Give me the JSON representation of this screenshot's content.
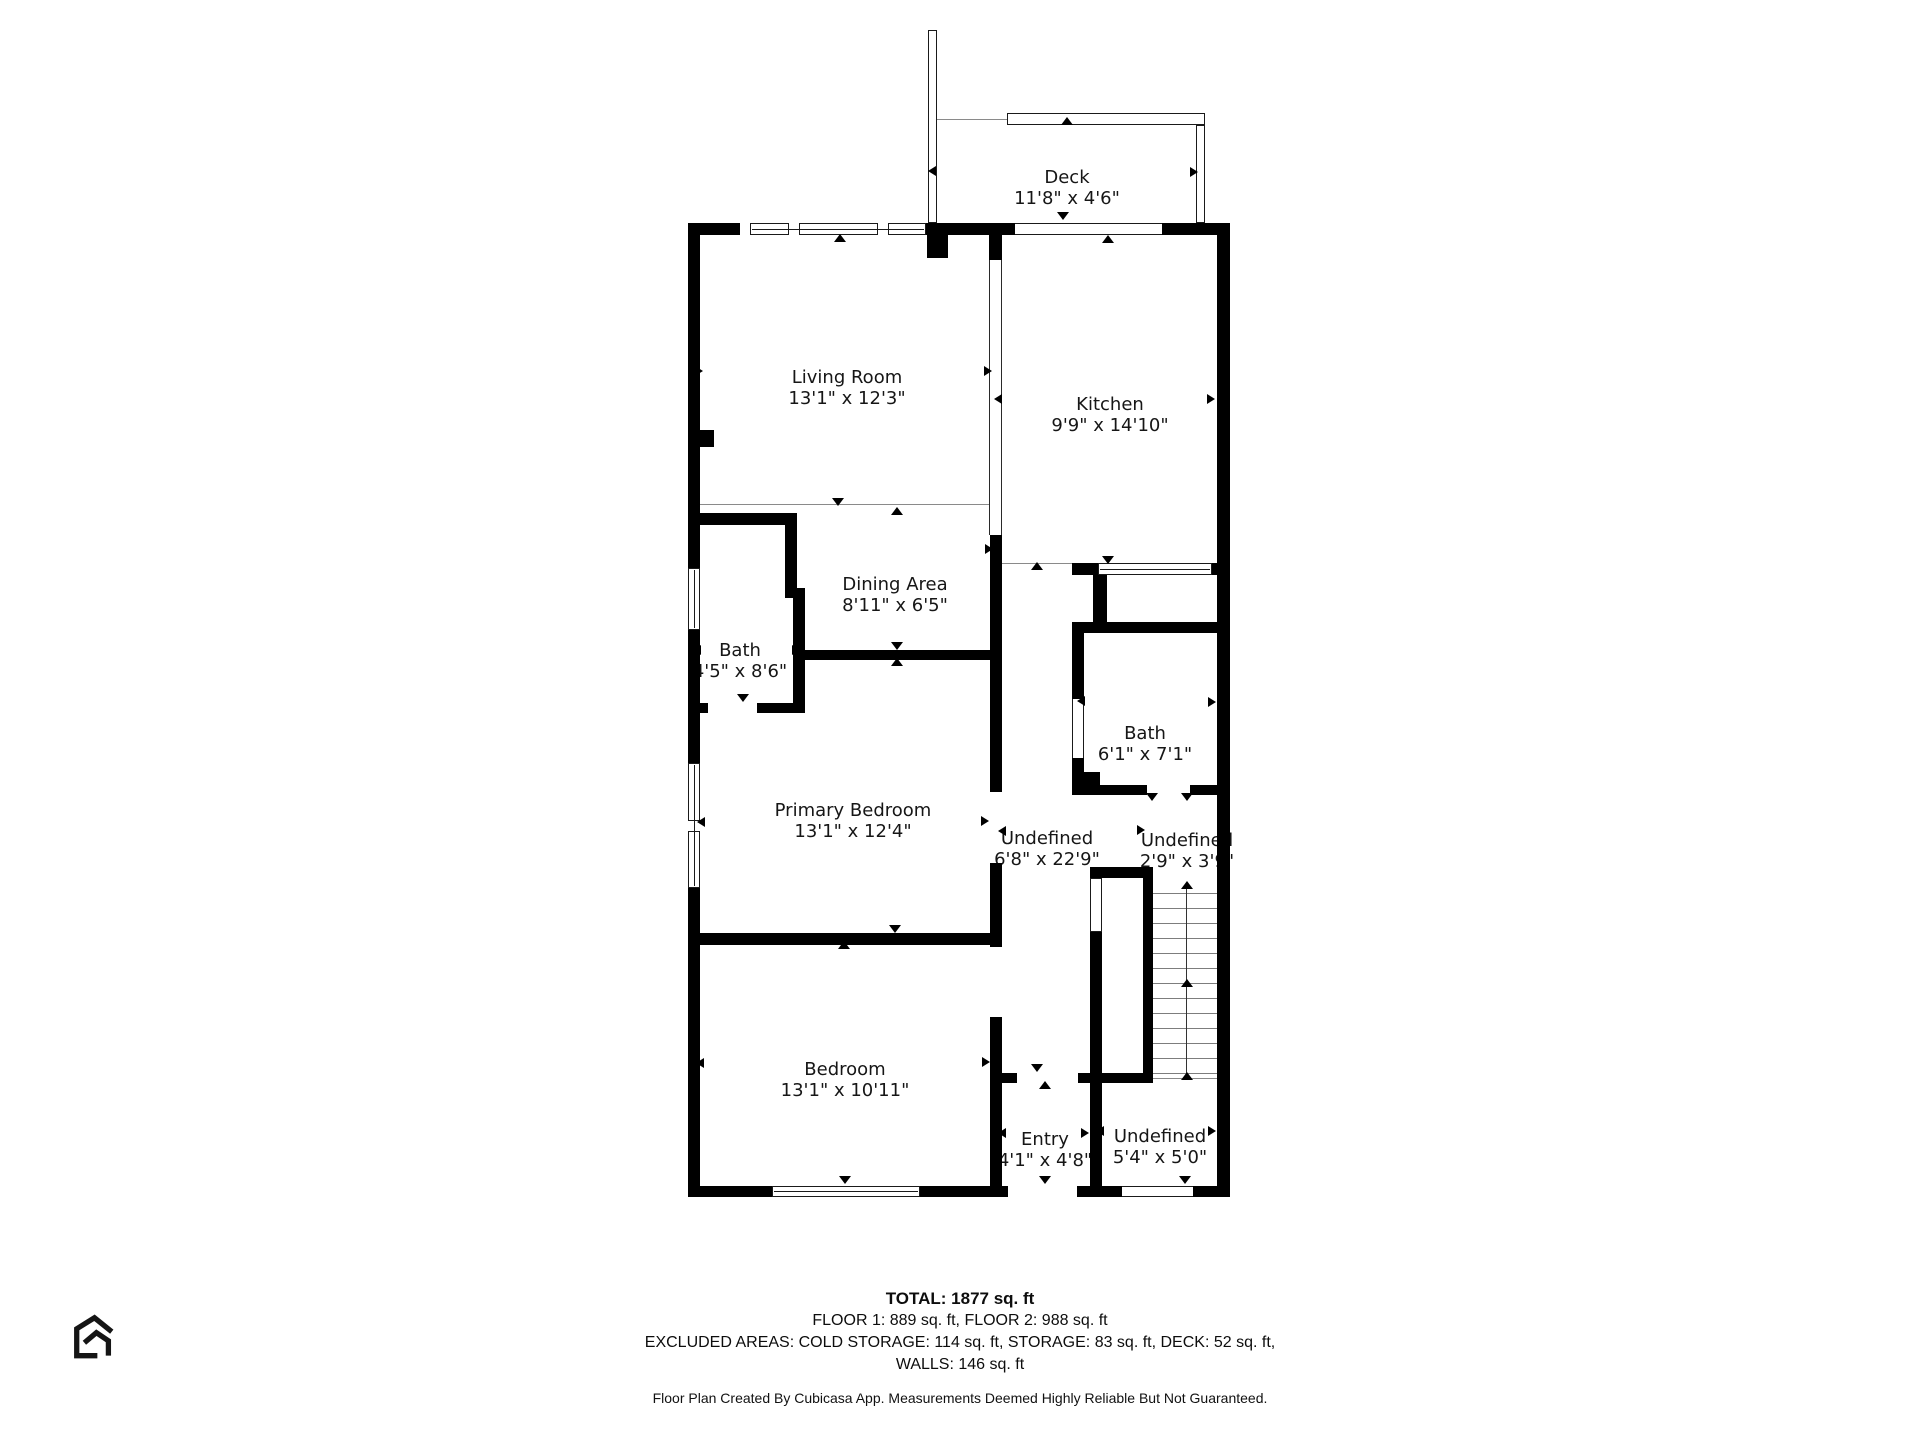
{
  "page": {
    "background": "#ffffff",
    "wall_color": "#000000"
  },
  "rooms": [
    {
      "id": "deck",
      "name": "Deck",
      "dims": "11'8\" x 4'6\"",
      "cx": 1067,
      "cy": 188
    },
    {
      "id": "living-room",
      "name": "Living Room",
      "dims": "13'1\" x 12'3\"",
      "cx": 847,
      "cy": 388
    },
    {
      "id": "kitchen",
      "name": "Kitchen",
      "dims": "9'9\" x 14'10\"",
      "cx": 1110,
      "cy": 415
    },
    {
      "id": "dining-area",
      "name": "Dining Area",
      "dims": "8'11\" x 6'5\"",
      "cx": 895,
      "cy": 595
    },
    {
      "id": "bath-1",
      "name": "Bath",
      "dims": "4'5\" x 8'6\"",
      "cx": 740,
      "cy": 661
    },
    {
      "id": "bath-2",
      "name": "Bath",
      "dims": "6'1\" x 7'1\"",
      "cx": 1145,
      "cy": 744
    },
    {
      "id": "primary-bedroom",
      "name": "Primary Bedroom",
      "dims": "13'1\" x 12'4\"",
      "cx": 853,
      "cy": 821
    },
    {
      "id": "hallway",
      "name": "Undefined",
      "dims": "6'8\" x 22'9\"",
      "cx": 1047,
      "cy": 849
    },
    {
      "id": "landing",
      "name": "Undefined",
      "dims": "2'9\" x 3'9\"",
      "cx": 1187,
      "cy": 851
    },
    {
      "id": "bedroom",
      "name": "Bedroom",
      "dims": "13'1\" x 10'11\"",
      "cx": 845,
      "cy": 1080
    },
    {
      "id": "entry",
      "name": "Entry",
      "dims": "4'1\" x 4'8\"",
      "cx": 1045,
      "cy": 1150
    },
    {
      "id": "storage",
      "name": "Undefined",
      "dims": "5'4\" x 5'0\"",
      "cx": 1160,
      "cy": 1147
    }
  ],
  "footer": {
    "total_line": "TOTAL: 1877 sq. ft",
    "floors_line": "FLOOR 1: 889 sq. ft, FLOOR 2: 988 sq. ft",
    "excluded_line": "EXCLUDED AREAS: COLD STORAGE: 114 sq. ft, STORAGE: 83 sq. ft, DECK: 52 sq. ft,",
    "walls_line": "WALLS: 146 sq. ft",
    "disclaimer": "Floor Plan Created By Cubicasa App. Measurements Deemed Highly Reliable But Not Guaranteed."
  },
  "branding": {
    "logo_icon": "cubicasa-house-logo"
  }
}
